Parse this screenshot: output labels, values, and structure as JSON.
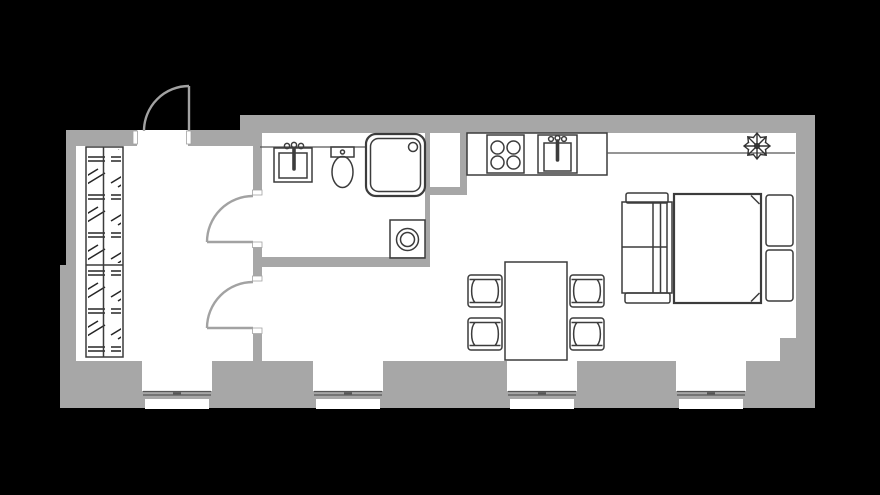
{
  "plan": {
    "type": "apartment-floor-plan",
    "rooms": [
      {
        "name": "hallway"
      },
      {
        "name": "bathroom"
      },
      {
        "name": "kitchen-living-room"
      }
    ],
    "counts": {
      "windows": 4,
      "doors": 3,
      "dining_chairs": 4,
      "stove_burners": 4,
      "pillows": 2
    },
    "furniture_icons": [
      "wardrobe-icon",
      "entrance-door-icon",
      "bathroom-door-icon",
      "room-door-icon",
      "bathroom-sink-icon",
      "toilet-icon",
      "shower-icon",
      "washing-machine-icon",
      "kitchen-counter-icon",
      "stove-icon",
      "kitchen-sink-icon",
      "shelf-icon",
      "plant-icon",
      "dining-table-icon",
      "chair-icon",
      "sofa-icon",
      "double-bed-icon",
      "pillow-icon",
      "window-icon"
    ]
  },
  "colors": {
    "background": "#000000",
    "wall": "#a7a7a7",
    "floor": "#ffffff",
    "furniture_stroke": "#3c3c3c",
    "thin_line": "#565656",
    "door_stroke": "#a2a2a2"
  }
}
